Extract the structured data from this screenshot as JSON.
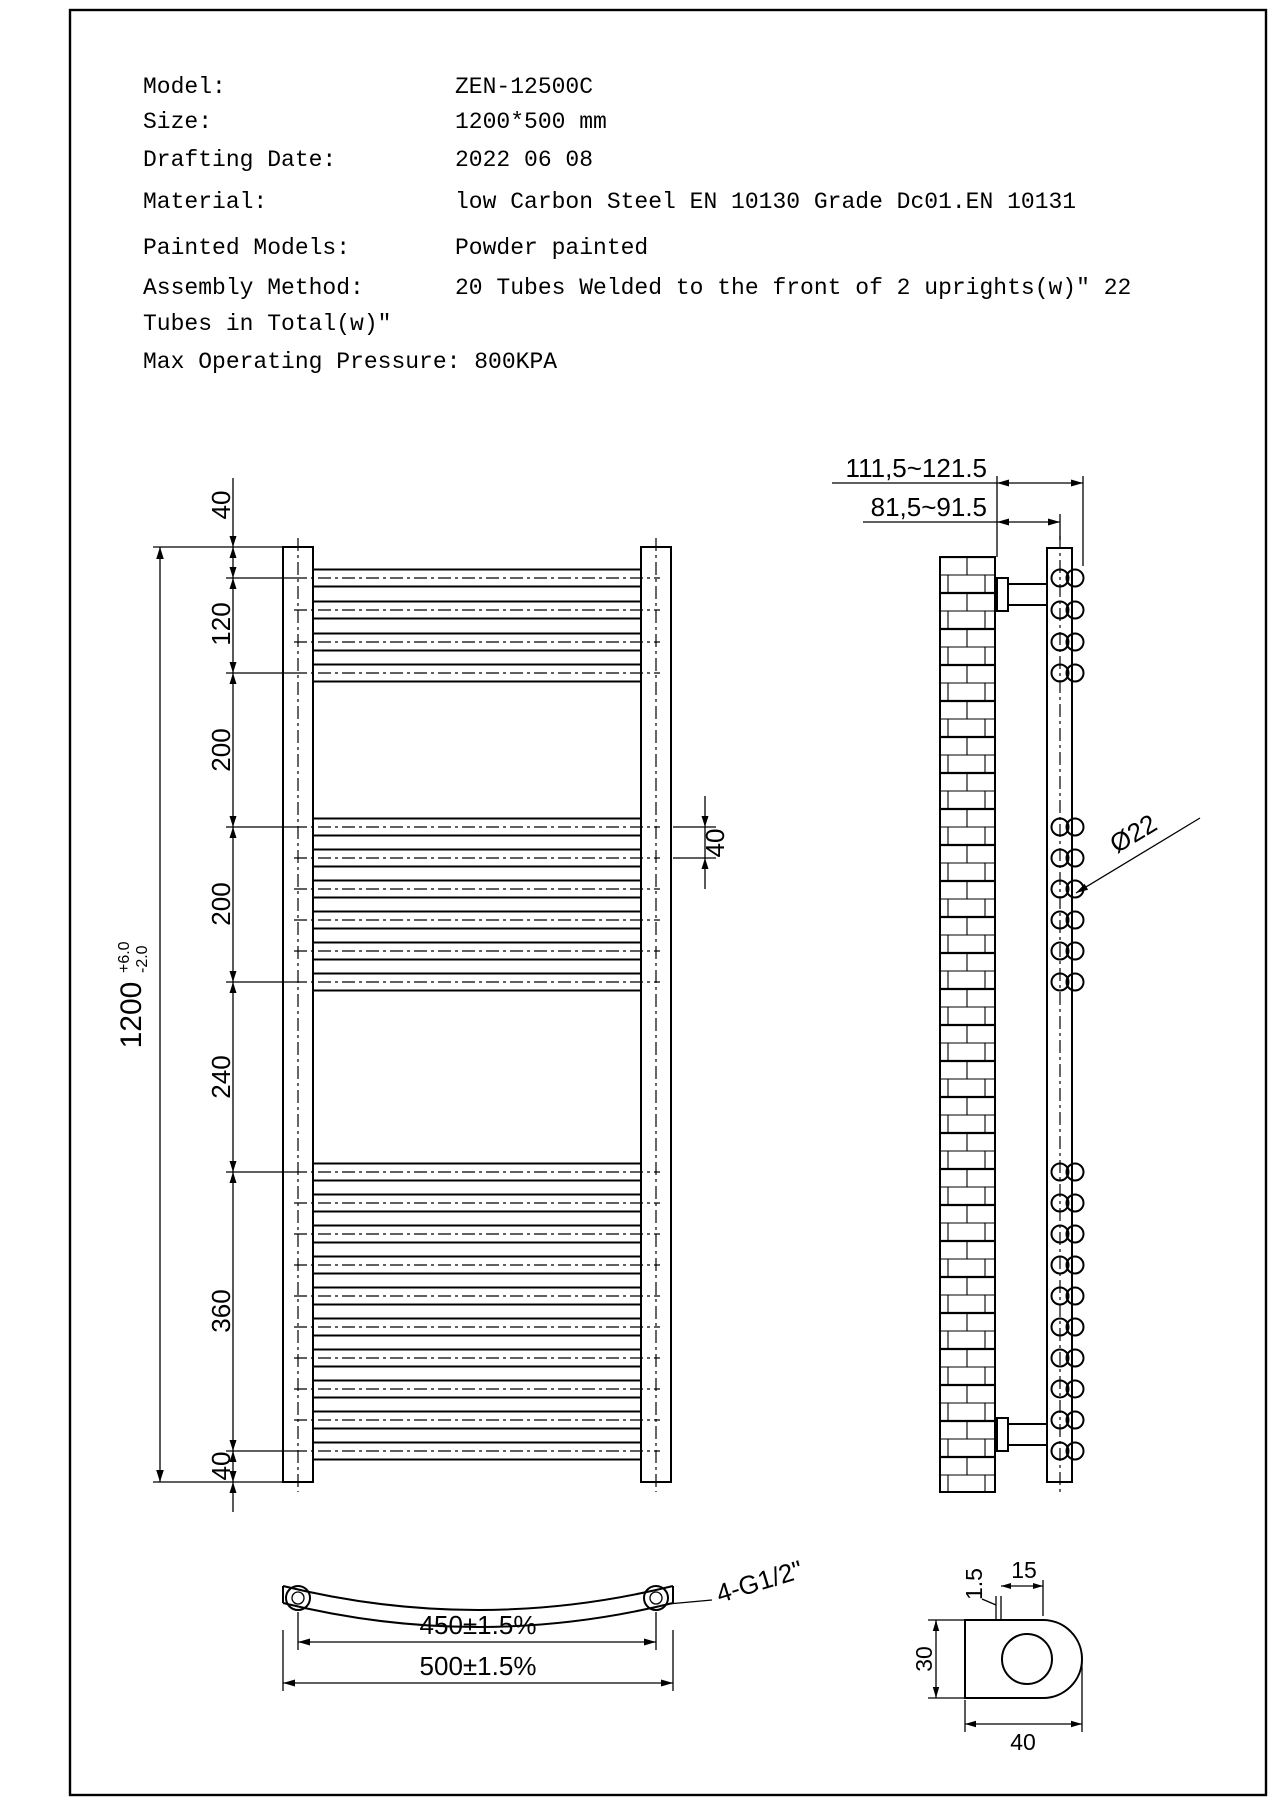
{
  "header": {
    "rows": [
      {
        "label": "Model:",
        "value": "ZEN-12500C"
      },
      {
        "label": "Size:",
        "value": "1200*500 mm"
      },
      {
        "label": "Drafting Date:",
        "value": "2022 06 08"
      },
      {
        "label": "Material:",
        "value": "low Carbon Steel  EN 10130 Grade Dc01.EN 10131"
      },
      {
        "label": "Painted Models:",
        "value": "Powder painted"
      },
      {
        "label": "Assembly Method:",
        "value": "20 Tubes Welded to the front of 2 uprights(w)\"  22"
      }
    ],
    "wrap_line": "Tubes in Total(w)\"",
    "pressure_line": "Max Operating Pressure: 800KPA"
  },
  "front_view": {
    "overall_dim": "1200",
    "tol_plus": "+6.0",
    "tol_minus": "-2.0",
    "chain_dims": [
      "40",
      "120",
      "200",
      "200",
      "240",
      "360",
      "40"
    ],
    "tube_gap_dim": "40"
  },
  "side_view": {
    "dim_wall_to_front": "111,5~121.5",
    "dim_wall_to_center": "81,5~91.5",
    "tube_diameter": "Ø22"
  },
  "bottom_view": {
    "connection_label": "4-G1/2\"",
    "dim_centers": "450±1.5%",
    "dim_overall": "500±1.5%"
  },
  "detail_view": {
    "wall_thickness": "1.5",
    "dim_top": "15",
    "dim_height": "30",
    "dim_width": "40"
  },
  "geometry": {
    "tube_centers": [
      578,
      610,
      642,
      673,
      827,
      858,
      889,
      920,
      951,
      982,
      1172,
      1203,
      1234,
      1265,
      1296,
      1327,
      1358,
      1389,
      1420,
      1451
    ],
    "chain_boundaries": [
      547,
      578,
      673,
      827,
      982,
      1172,
      1451,
      1482
    ],
    "tube_left_x": 313,
    "tube_right_x": 641,
    "centerline_left_x": 294,
    "centerline_right_x": 660,
    "tube_half_height": 8.5,
    "chain_line_x": 233,
    "side_circle_x1": 1060,
    "side_circle_x2": 1075,
    "side_circle_r": 8.5
  }
}
